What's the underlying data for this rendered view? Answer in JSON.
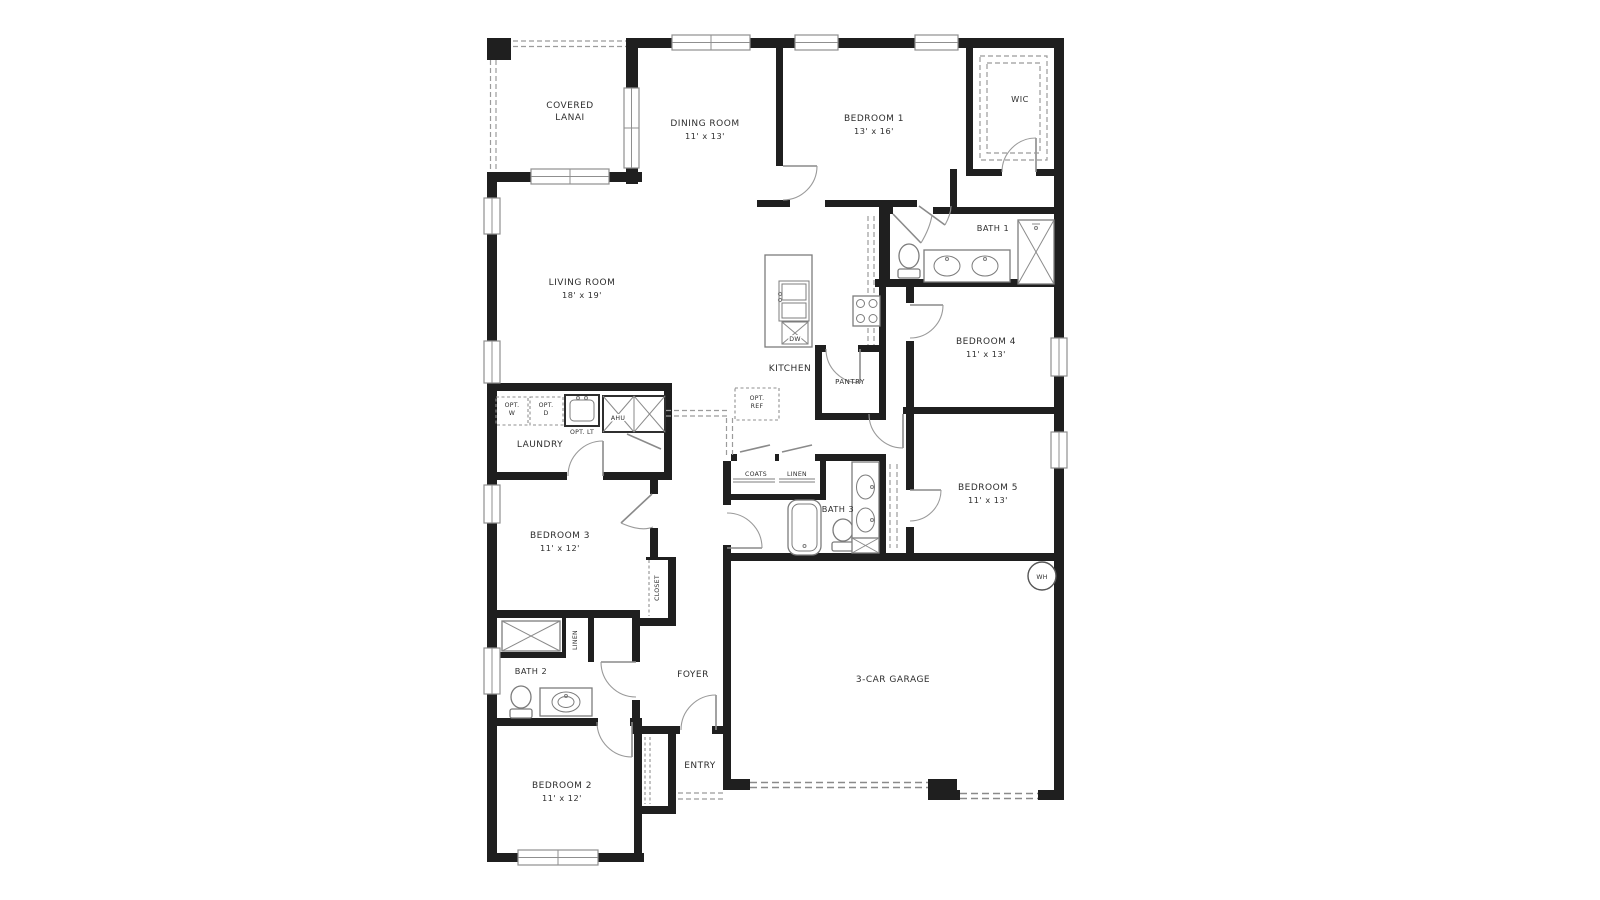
{
  "floorplan": {
    "rooms": {
      "covered_lanai": {
        "line1": "COVERED",
        "line2": "LANAI"
      },
      "dining_room": {
        "line1": "DINING ROOM",
        "line2": "11' x 13'"
      },
      "bedroom_1": {
        "line1": "BEDROOM 1",
        "line2": "13' x 16'"
      },
      "wic": {
        "label": "WIC"
      },
      "bath_1": {
        "label": "BATH 1"
      },
      "living_room": {
        "line1": "LIVING ROOM",
        "line2": "18' x 19'"
      },
      "kitchen": {
        "label": "KITCHEN"
      },
      "pantry": {
        "label": "PANTRY"
      },
      "bedroom_4": {
        "line1": "BEDROOM 4",
        "line2": "11' x 13'"
      },
      "laundry": {
        "label": "LAUNDRY"
      },
      "bath_3": {
        "label": "BATH 3"
      },
      "bedroom_5": {
        "line1": "BEDROOM 5",
        "line2": "11' x 13'"
      },
      "bedroom_3": {
        "line1": "BEDROOM 3",
        "line2": "11' x 12'"
      },
      "bath_2": {
        "label": "BATH 2"
      },
      "foyer": {
        "label": "FOYER"
      },
      "entry": {
        "label": "ENTRY"
      },
      "garage": {
        "label": "3-CAR GARAGE"
      },
      "bedroom_2": {
        "line1": "BEDROOM 2",
        "line2": "11' x 12'"
      }
    },
    "callouts": {
      "opt_w": {
        "line1": "OPT.",
        "line2": "W"
      },
      "opt_d": {
        "line1": "OPT.",
        "line2": "D"
      },
      "opt_lt": {
        "label": "OPT. LT"
      },
      "ahu": {
        "label": "AHU"
      },
      "opt_ref": {
        "line1": "OPT.",
        "line2": "REF"
      },
      "coats": {
        "label": "COATS"
      },
      "linen_hall": {
        "label": "LINEN"
      },
      "linen_bath2": {
        "label": "LINEN"
      },
      "closet_bedroom3": {
        "label": "CLOSET"
      },
      "dishwasher": {
        "label": "DW"
      },
      "water_heater": {
        "label": "WH"
      }
    },
    "colors": {
      "wall": "#1f1f1f",
      "fixture_line": "#7c7c7c",
      "dash_line": "#9b9b9b",
      "text": "#2e2e2e",
      "background": "#ffffff"
    }
  }
}
